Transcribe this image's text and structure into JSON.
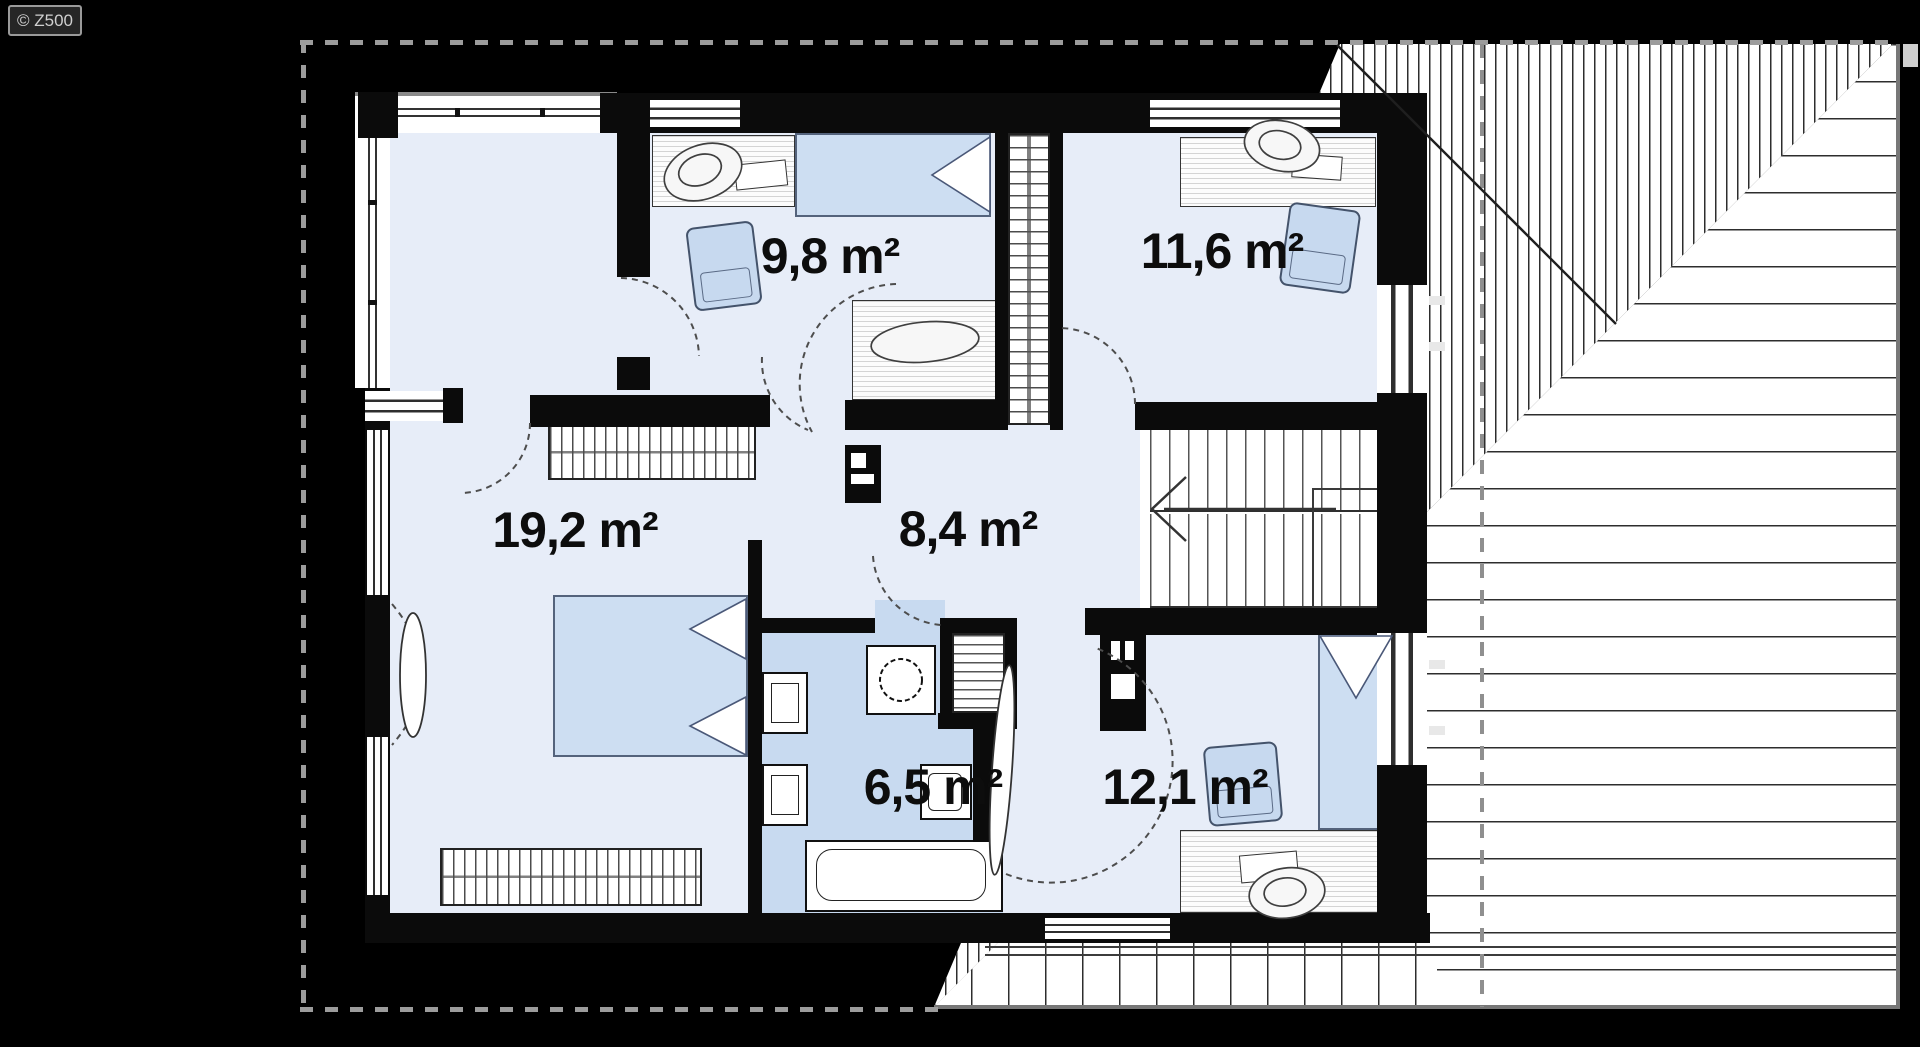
{
  "watermark": {
    "label": "© Z500"
  },
  "rooms": {
    "r98": {
      "name": "bedroom-top-left",
      "label": "9,8 m²"
    },
    "r116": {
      "name": "bedroom-top-right",
      "label": "11,6 m²"
    },
    "r192": {
      "name": "bedroom-left",
      "label": "19,2 m²"
    },
    "r84": {
      "name": "hallway",
      "label": "8,4 m²"
    },
    "r65": {
      "name": "bathroom",
      "label": "6,5 m²"
    },
    "r121": {
      "name": "bedroom-bottom-right",
      "label": "12,1 m²"
    }
  },
  "colors": {
    "background": "#000000",
    "floor": "#e7edf8",
    "bathroom_floor": "#c8daf0",
    "furniture_blue": "#cddef2",
    "wall": "#0b0b0b",
    "roof_line": "#2d2d2d",
    "dashed_eaves": "#9c9c9c"
  }
}
